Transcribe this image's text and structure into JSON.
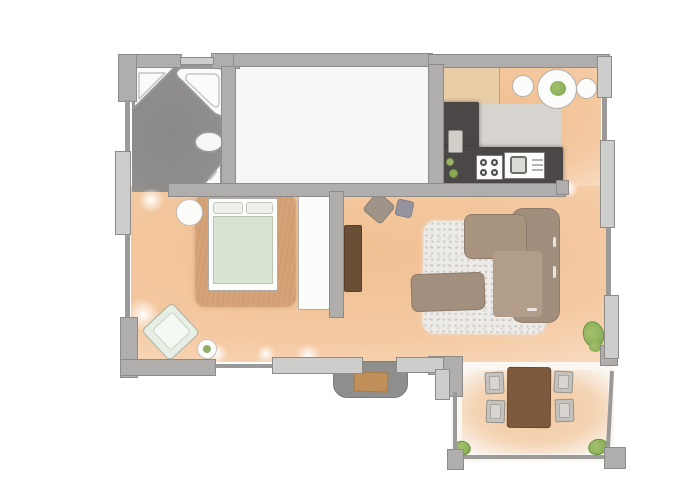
{
  "page": {
    "background": "#ffffff",
    "kind": "watercolor-floor-plan"
  },
  "palette": {
    "page_bg": "#ffffff",
    "wall": "#b0aeac",
    "wall_outline": "#8e8c8a",
    "window": "#cdcdcb",
    "rail": "#9c9a98",
    "floor_main": "#f4c9a1",
    "floor_main_light": "#f9ddc3",
    "floor_bath": "#908e8c",
    "floor_empty": "#f6f6f4",
    "floor_terrace": "#faf6f1",
    "counter_dark": "#4a4746",
    "counter_light": "#d7d4cf",
    "cabinet": "#e9cda6",
    "white": "#fcfcfa",
    "duvet": "#d8e3d1",
    "rug_bed": "#c08a5c",
    "rug_living": "#edebe7",
    "sofa": "#a28e7d",
    "sofa_light": "#b19d8a",
    "wood": "#6b4e36",
    "outdoor_table": "#7d5a3d",
    "chair": "#c6c3bf",
    "plant": "#8db15c",
    "plant_dark": "#6e9340",
    "doormat": "#c18f59",
    "stoop": "#8e8e8c"
  },
  "plan": {
    "rooms": [
      {
        "id": "bathroom",
        "floor": "dark-gray",
        "fixtures": [
          "corner-shower",
          "corner-bathtub",
          "toilet",
          "corner-sink"
        ]
      },
      {
        "id": "empty-room",
        "floor": "white",
        "fixtures": []
      },
      {
        "id": "kitchen",
        "floor": "terracotta",
        "fixtures": [
          "tall-cabinet",
          "l-shaped-counter",
          "cutting-board",
          "stove-4-burner",
          "sink-unit",
          "bottles",
          "round-table-with-plant",
          "stool",
          "stool"
        ]
      },
      {
        "id": "bedroom",
        "floor": "terracotta",
        "fixtures": [
          "area-rug",
          "double-bed",
          "pillow",
          "pillow",
          "duvet",
          "round-nightstand",
          "wardrobe",
          "armchair",
          "plant-stool"
        ]
      },
      {
        "id": "living-room",
        "floor": "terracotta",
        "fixtures": [
          "tv-stand",
          "pouf",
          "pouf",
          "speckled-rug",
          "corner-sofa",
          "coffee-table",
          "potted-plant"
        ]
      },
      {
        "id": "entrance",
        "floor": "none",
        "fixtures": [
          "stoop",
          "doormat"
        ]
      },
      {
        "id": "terrace",
        "floor": "light",
        "fixtures": [
          "dining-table",
          "chair",
          "chair",
          "chair",
          "chair",
          "corner-plant",
          "corner-plant",
          "railing",
          "corner-posts"
        ]
      }
    ],
    "openings": [
      "bathroom-doorway",
      "entrance-door",
      "kitchen-living-passage"
    ],
    "window_segments": {
      "left_wall": 1,
      "top_wall": 1,
      "right_wall": 3
    }
  }
}
